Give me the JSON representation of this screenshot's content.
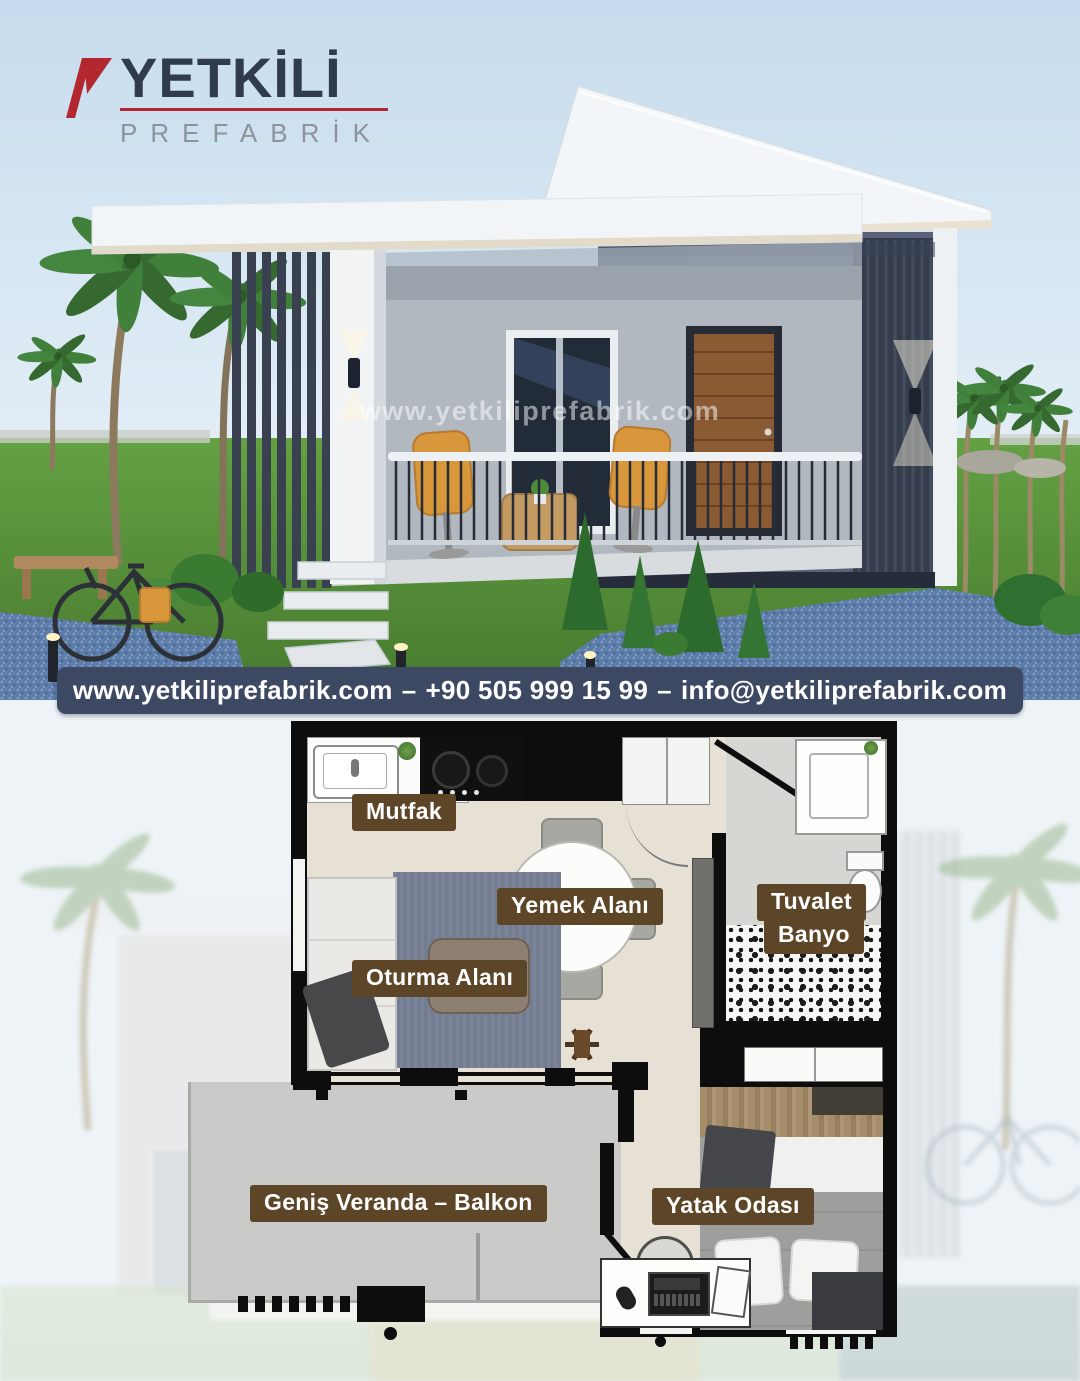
{
  "logo": {
    "title": "YETKİLİ",
    "subtitle": "PREFABRİK"
  },
  "hero": {
    "watermark": "www.yetkiliprefabrik.com"
  },
  "contact_banner": {
    "website": "www.yetkiliprefabrik.com",
    "separator": "–",
    "phone": "+90 505 999 15 99",
    "email": "info@yetkiliprefabrik.com"
  },
  "floor_plan": {
    "labels": {
      "kitchen": "Mutfak",
      "dining": "Yemek Alanı",
      "living": "Oturma Alanı",
      "toilet": "Tuvalet",
      "bath": "Banyo",
      "veranda": "Geniş Veranda – Balkon",
      "bedroom": "Yatak Odası"
    }
  },
  "colors": {
    "banner_bg": "#3d4963",
    "label_bg": "#5d4527",
    "logo_red": "#b3282e",
    "logo_navy": "#303b4e",
    "house_wall_slate": "#59627a",
    "slat_dark": "#353c4b",
    "gravel_blue": "#5d7dab",
    "grass_green": "#519138"
  }
}
